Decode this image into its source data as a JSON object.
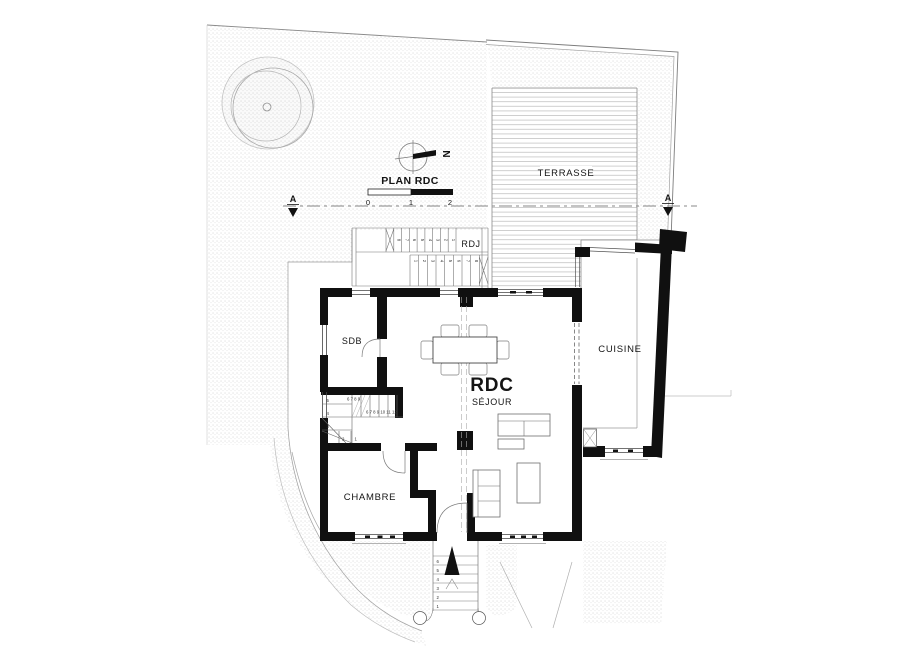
{
  "plan": {
    "title": "PLAN RDC",
    "north": "N",
    "scale": [
      "0",
      "1",
      "2"
    ],
    "section": {
      "left": "A",
      "right": "A"
    },
    "rooms": {
      "terrasse": "TERRASSE",
      "rdj": "RDJ",
      "sdb": "SDB",
      "level": "RDC",
      "sejour": "SÉJOUR",
      "chambre": "CHAMBRE",
      "cuisine": "CUISINE"
    },
    "stairs": {
      "interior": {
        "winder": [
          "5",
          "4",
          "3",
          "2",
          "1"
        ],
        "mid": "6 7 8 9",
        "upper": "6 7 8 9 10 11 12"
      },
      "rdj_upper": [
        "8",
        "7",
        "6",
        "5",
        "4",
        "3",
        "2",
        "1"
      ],
      "rdj_lower": [
        "1",
        "2",
        "3",
        "4",
        "5",
        "6",
        "7",
        "8"
      ],
      "entrance": [
        "6",
        "5",
        "4",
        "3",
        "2",
        "1"
      ]
    },
    "colors": {
      "ink": "#141414",
      "wall": "#101010",
      "line": "#6b6b6b",
      "faint": "#b5b5b5",
      "terrain_dot": "#c9c9c9"
    }
  }
}
